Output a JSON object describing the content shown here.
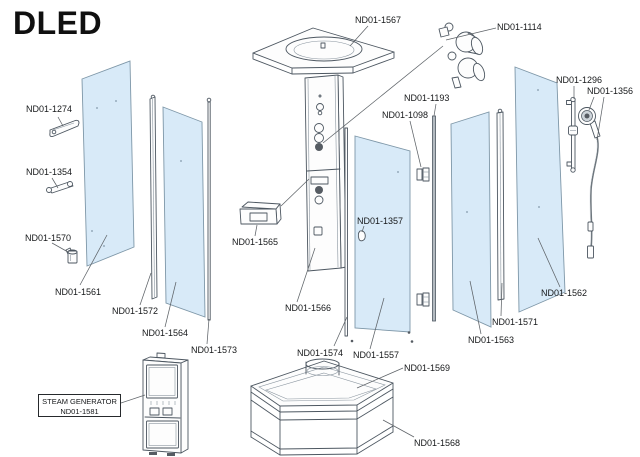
{
  "title": "DLED",
  "parts": {
    "p1567": "ND01-1567",
    "p1114": "ND01-1114",
    "p1274": "ND01-1274",
    "p1296": "ND01-1296",
    "p1356": "ND01-1356",
    "p1193": "ND01-1193",
    "p1098": "ND01-1098",
    "p1354": "ND01-1354",
    "p1357": "ND01-1357",
    "p1570": "ND01-1570",
    "p1565": "ND01-1565",
    "p1561": "ND01-1561",
    "p1562": "ND01-1562",
    "p1572": "ND01-1572",
    "p1566": "ND01-1566",
    "p1571": "ND01-1571",
    "p1564": "ND01-1564",
    "p1563": "ND01-1563",
    "p1573": "ND01-1573",
    "p1574": "ND01-1574",
    "p1557": "ND01-1557",
    "p1569": "ND01-1569",
    "p1568": "ND01-1568"
  },
  "steam_generator_label": {
    "line1": "STEAM GENERATOR",
    "line2": "ND01-1581"
  },
  "colors": {
    "glass": "#d8eaf8",
    "line": "#4d5761",
    "label-text": "#16181a",
    "bg": "#ffffff"
  }
}
